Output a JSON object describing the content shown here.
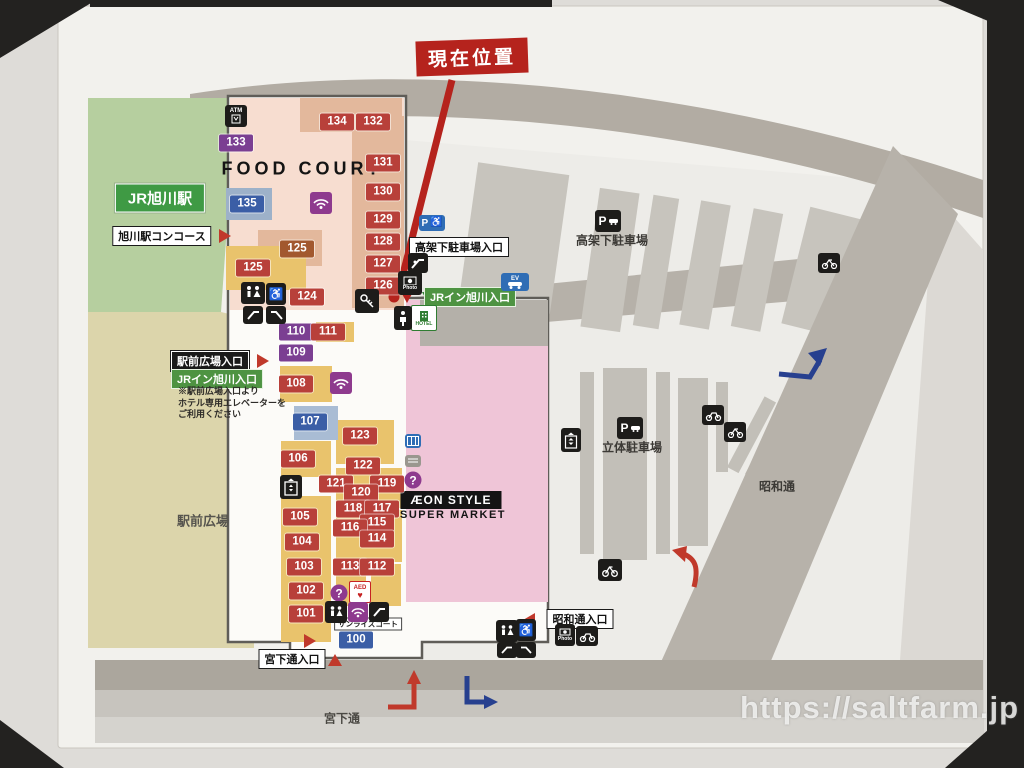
{
  "banner": {
    "current_location": "現在位置"
  },
  "watermark": "https://saltfarm.jp",
  "areas": {
    "station": "JR旭川駅",
    "plaza": "駅前広場",
    "elevated_parking": "高架下駐車場",
    "multistory_parking": "立体駐車場",
    "showa_street": "昭和通",
    "miyashita_street": "宮下通"
  },
  "entrances": {
    "concourse": "旭川駅コンコース",
    "elevated_parking_entrance": "高架下駐車場入口",
    "jr_inn_entrance_top": "JRイン旭川入口",
    "plaza_entrance": "駅前広場入口",
    "jr_inn_entrance_left": "JRイン旭川入口",
    "showa_entrance": "昭和通入口",
    "miyashita_entrance": "宮下通入口"
  },
  "notes": {
    "line1": "※駅前広場入口より",
    "line2": "ホテル専用エレベーターを",
    "line3": "ご利用ください"
  },
  "store": {
    "food_court": "FOOD COURT",
    "aeon": "ÆON STYLE",
    "supermarket": "SUPER MARKET",
    "sunrise_court": "サンライズコート"
  },
  "icons": {
    "atm": "ATM",
    "parking": "P",
    "photo": "Photo",
    "hotel": "HOTEL",
    "aed": "AED",
    "info": "?",
    "ev": "EV",
    "accessible_parking": "P"
  },
  "units": {
    "u100": "100",
    "u101": "101",
    "u102": "102",
    "u103": "103",
    "u104": "104",
    "u105": "105",
    "u106": "106",
    "u107": "107",
    "u108": "108",
    "u109": "109",
    "u110": "110",
    "u111": "111",
    "u112": "112",
    "u113": "113",
    "u114": "114",
    "u115": "115",
    "u116": "116",
    "u117": "117",
    "u118": "118",
    "u119": "119",
    "u120": "120",
    "u121": "121",
    "u122": "122",
    "u123": "123",
    "u124": "124",
    "u125a": "125",
    "u125b": "125",
    "u126": "126",
    "u127": "127",
    "u128": "128",
    "u129": "129",
    "u130": "130",
    "u131": "131",
    "u132": "132",
    "u133": "133",
    "u134": "134",
    "u135": "135"
  }
}
